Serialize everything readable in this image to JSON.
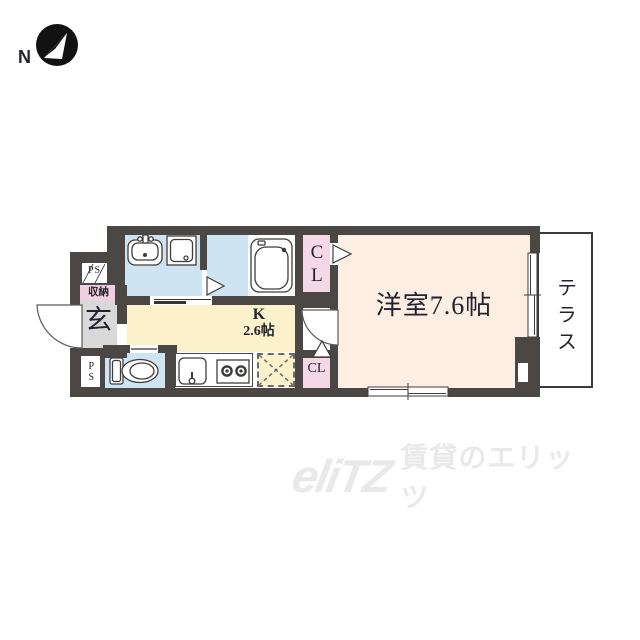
{
  "compass": {
    "label": "N"
  },
  "floorplan": {
    "rooms": {
      "western_room": {
        "label": "洋室7.6帖"
      },
      "kitchen": {
        "label": "K",
        "size": "2.6帖"
      },
      "terrace": {
        "label": "テラス"
      },
      "entrance": {
        "label": "玄"
      },
      "storage": {
        "label": "収納"
      },
      "closet_upper": {
        "label": "CL"
      },
      "closet_lower": {
        "label": "CL"
      },
      "pipe_space_upper": {
        "label": "PS"
      },
      "pipe_space_lower": {
        "label": "PS"
      }
    },
    "fixtures": [
      "bathtub",
      "washbasin",
      "washing-machine-pan",
      "toilet",
      "kitchen-sink",
      "gas-stove",
      "refrigerator-space"
    ],
    "colors": {
      "wall": "#4b4745",
      "water_rooms": "#cfe4f3",
      "kitchen_floor": "#fbf2cb",
      "main_room_floor": "#fdeee3",
      "closet": "#f4d8e6",
      "storage": "#f2cfe0",
      "entrance_floor": "#d9d9d9"
    }
  },
  "watermark": {
    "logo": "eliTZ",
    "text": "賃貸のエリッツ"
  }
}
